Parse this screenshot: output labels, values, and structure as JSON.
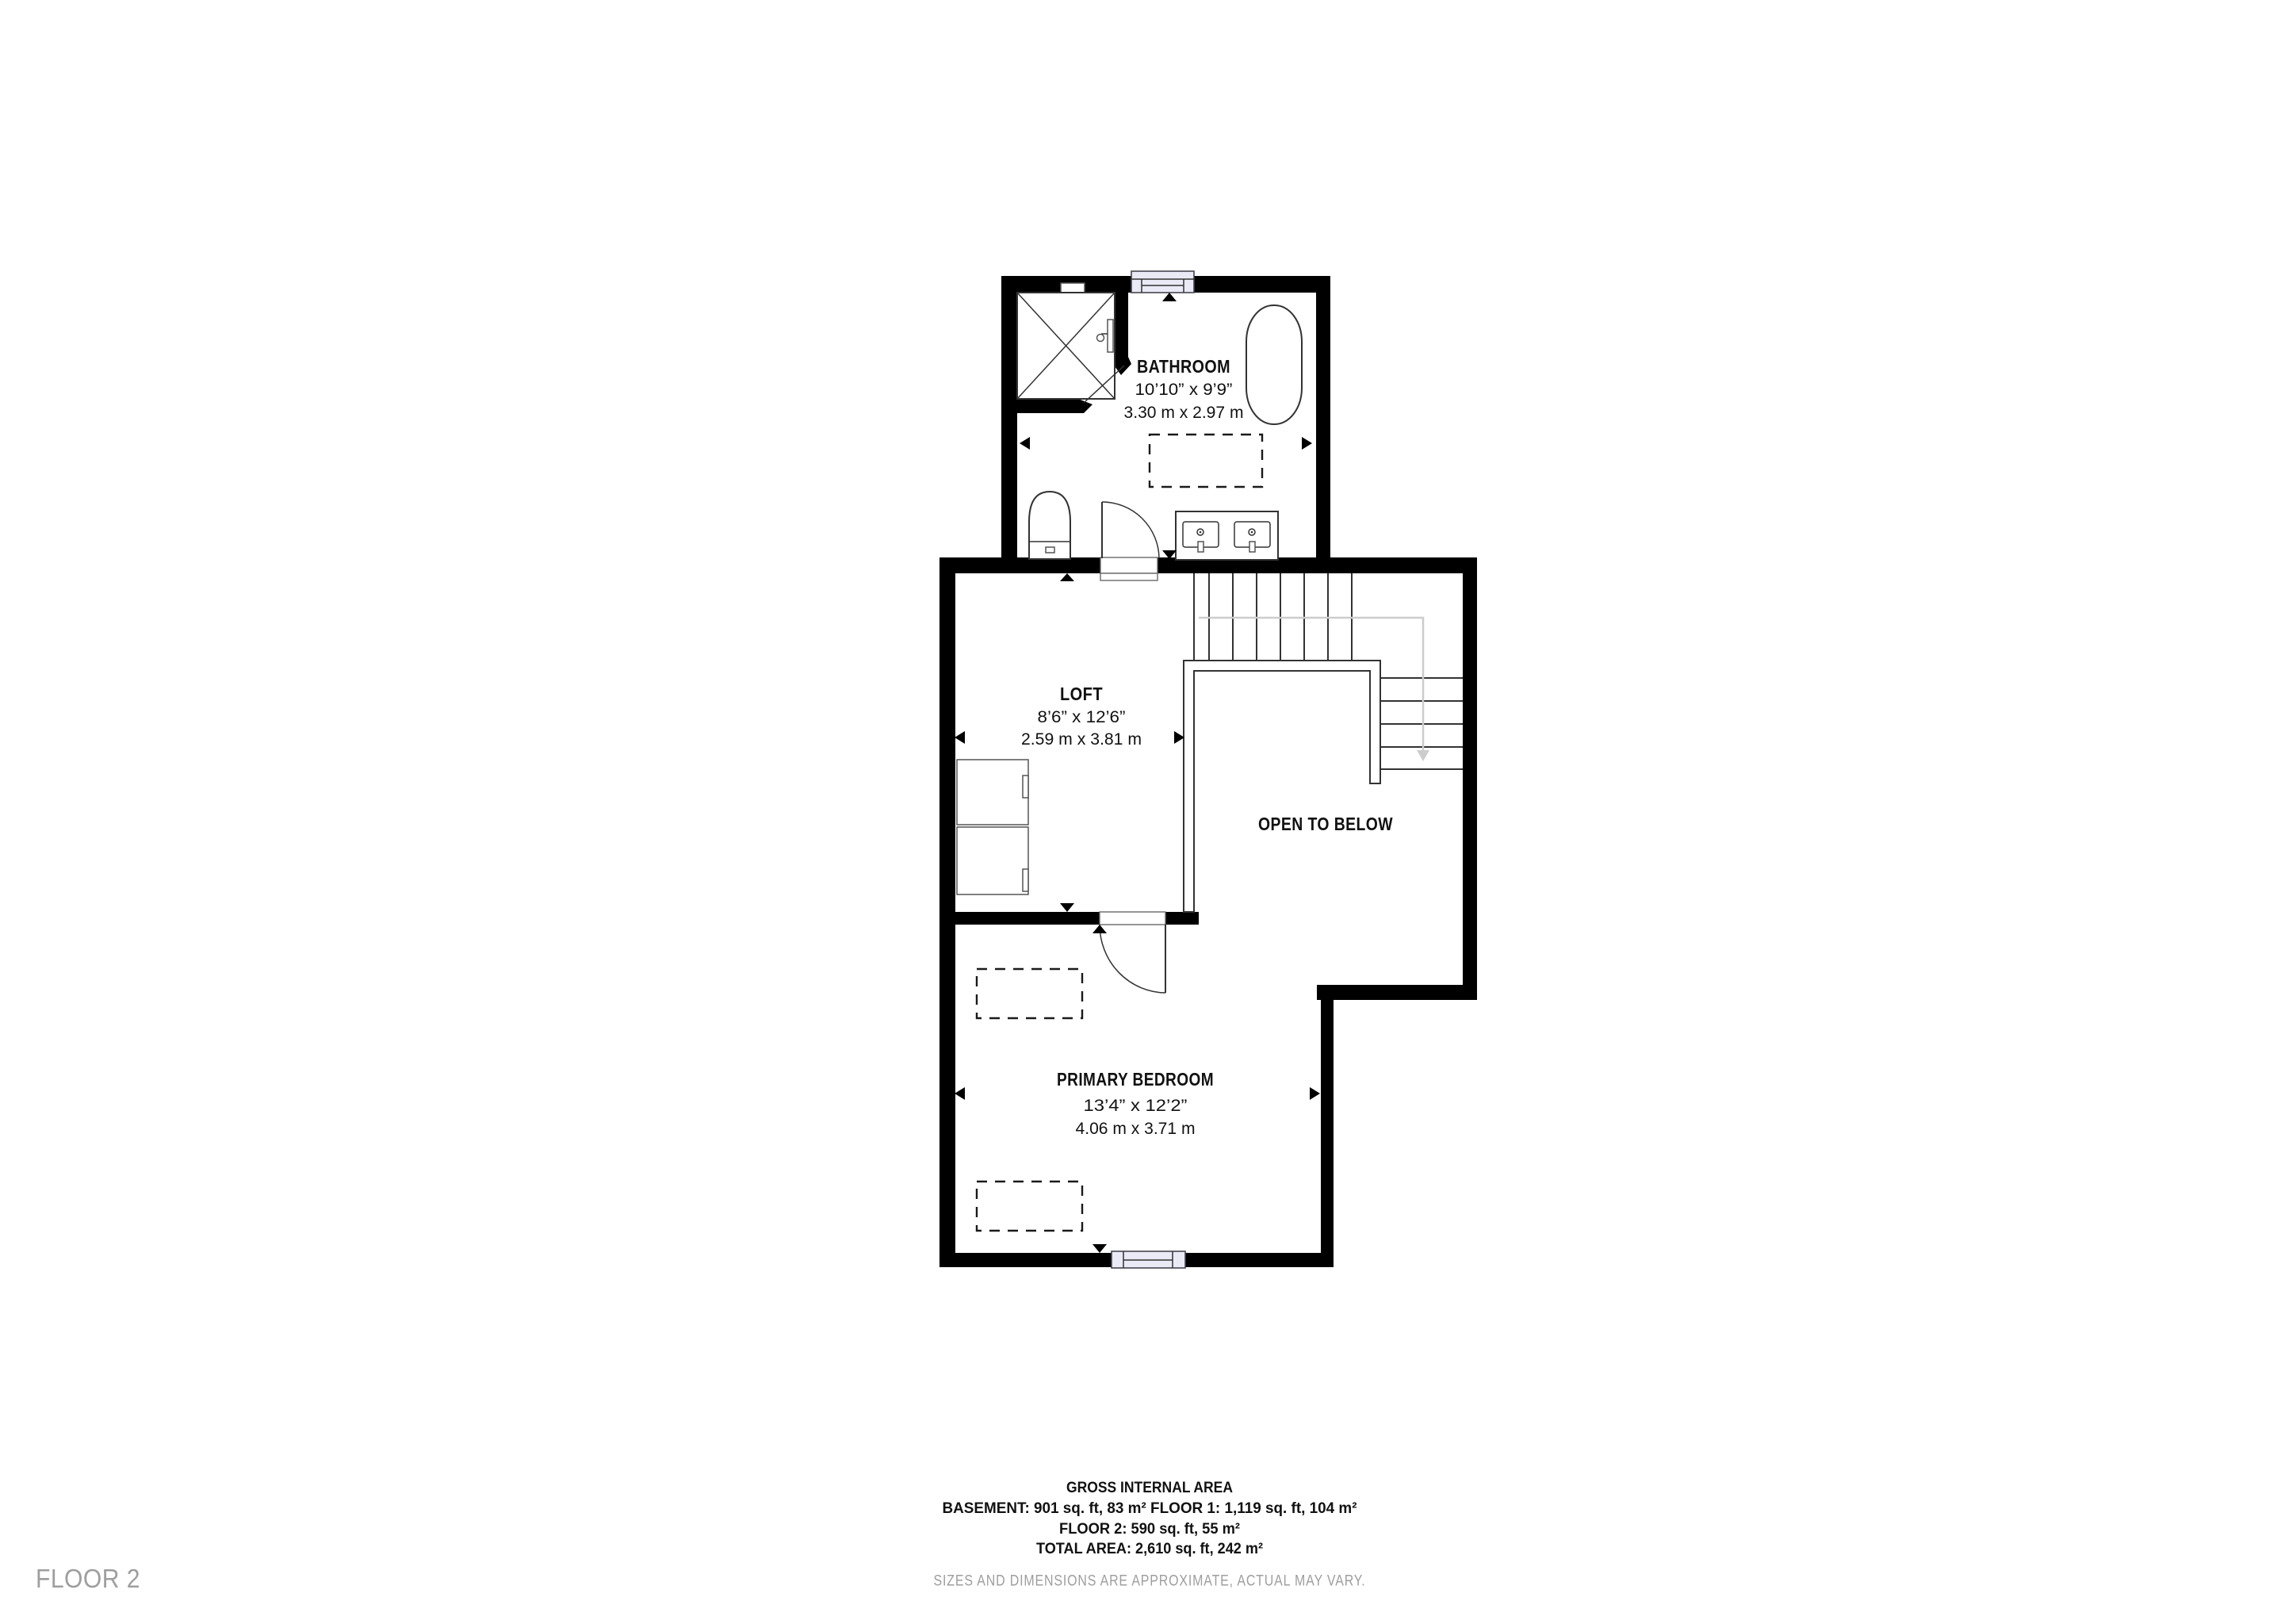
{
  "page": {
    "floor_label": "FLOOR 2"
  },
  "rooms": {
    "bathroom": {
      "name": "BATHROOM",
      "imperial": "10’10” x 9’9”",
      "metric": "3.30 m x 2.97 m"
    },
    "loft": {
      "name": "LOFT",
      "imperial": "8’6” x 12’6”",
      "metric": "2.59 m x 3.81 m"
    },
    "open_to_below": {
      "name": "OPEN TO BELOW"
    },
    "primary_bedroom": {
      "name": "PRIMARY BEDROOM",
      "imperial": "13’4” x 12’2”",
      "metric": "4.06 m x 3.71 m"
    }
  },
  "footer": {
    "title": "GROSS INTERNAL AREA",
    "area_line_1": "BASEMENT: 901 sq. ft, 83 m² FLOOR 1: 1,119 sq. ft, 104 m²",
    "area_line_2": "FLOOR 2: 590 sq. ft, 55 m²",
    "area_line_3": "TOTAL AREA: 2,610 sq. ft, 242 m²",
    "disclaimer": "SIZES AND DIMENSIONS ARE APPROXIMATE, ACTUAL MAY VARY."
  },
  "colors": {
    "wall": "#000000",
    "line": "#333333",
    "window_fill": "#e9eaf5",
    "muted_text": "#9e9e9e",
    "guide": "#cccccc"
  }
}
